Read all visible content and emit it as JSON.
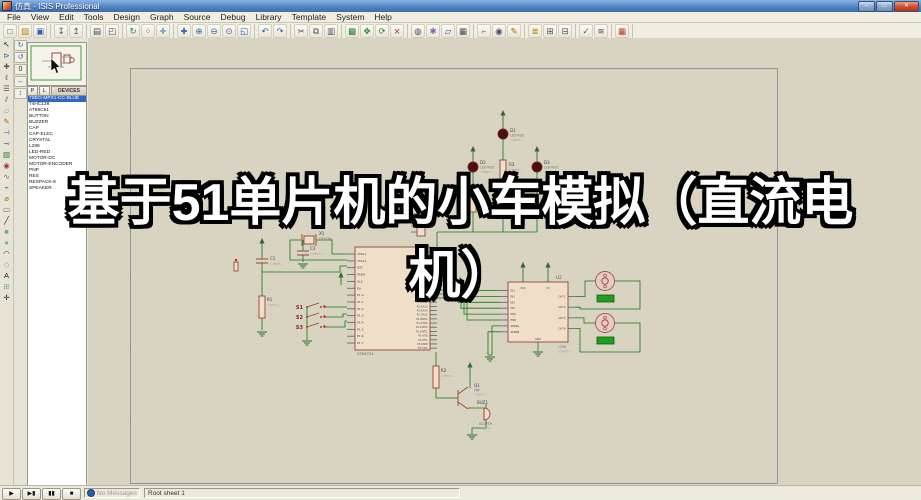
{
  "window": {
    "title": "仿真 - ISIS Professional",
    "controls": {
      "minimize": "–",
      "maximize": "□",
      "close": "✕"
    }
  },
  "menu": {
    "items": [
      "File",
      "View",
      "Edit",
      "Tools",
      "Design",
      "Graph",
      "Source",
      "Debug",
      "Library",
      "Template",
      "System",
      "Help"
    ]
  },
  "toolbar": {
    "groups": [
      [
        {
          "n": "new-file-icon",
          "g": "□"
        },
        {
          "n": "open-design-icon",
          "g": "▨",
          "c": "#b8860b"
        },
        {
          "n": "save-design-icon",
          "g": "▣",
          "c": "#2f5fa8"
        }
      ],
      [
        {
          "n": "import-section-icon",
          "g": "↧"
        },
        {
          "n": "export-section-icon",
          "g": "↥"
        }
      ],
      [
        {
          "n": "print-icon",
          "g": "▤"
        },
        {
          "n": "mark-output-area-icon",
          "g": "◰"
        }
      ],
      [
        {
          "n": "redraw-icon",
          "g": "↻",
          "c": "#2e7d32"
        },
        {
          "n": "toggle-grid-icon",
          "g": "⁘"
        },
        {
          "n": "false-origin-icon",
          "g": "✛",
          "c": "#2f5fa8"
        }
      ],
      [
        {
          "n": "center-at-cursor-icon",
          "g": "✚",
          "c": "#2f5fa8"
        },
        {
          "n": "zoom-in-icon",
          "g": "⊕",
          "c": "#2f5fa8"
        },
        {
          "n": "zoom-out-icon",
          "g": "⊖",
          "c": "#2f5fa8"
        },
        {
          "n": "zoom-all-icon",
          "g": "⊙",
          "c": "#2f5fa8"
        },
        {
          "n": "zoom-area-icon",
          "g": "◱",
          "c": "#2f5fa8"
        }
      ],
      [
        {
          "n": "undo-icon",
          "g": "↶",
          "c": "#2f5fa8"
        },
        {
          "n": "redo-icon",
          "g": "↷",
          "c": "#2f5fa8"
        }
      ],
      [
        {
          "n": "cut-icon",
          "g": "✂"
        },
        {
          "n": "copy-icon",
          "g": "⧉"
        },
        {
          "n": "paste-icon",
          "g": "▥"
        }
      ],
      [
        {
          "n": "block-copy-icon",
          "g": "▩",
          "c": "#2e7d32"
        },
        {
          "n": "block-move-icon",
          "g": "✥",
          "c": "#2e7d32"
        },
        {
          "n": "block-rotate-icon",
          "g": "⟳",
          "c": "#2e7d32"
        },
        {
          "n": "block-delete-icon",
          "g": "⨯",
          "c": "#a33333"
        }
      ],
      [
        {
          "n": "pick-parts-icon",
          "g": "◍"
        },
        {
          "n": "make-device-icon",
          "g": "✱",
          "c": "#8a5fb0"
        },
        {
          "n": "packaging-tool-icon",
          "g": "▱"
        },
        {
          "n": "decompose-icon",
          "g": "▦"
        }
      ],
      [
        {
          "n": "wire-autorouter-icon",
          "g": "⌐",
          "c": "#2e7d32"
        },
        {
          "n": "search-tag-icon",
          "g": "◉"
        },
        {
          "n": "property-assignment-icon",
          "g": "✎",
          "c": "#a66a00"
        }
      ],
      [
        {
          "n": "design-explorer-icon",
          "g": "≣",
          "c": "#b8860b"
        },
        {
          "n": "new-sheet-icon",
          "g": "⊞"
        },
        {
          "n": "remove-sheet-icon",
          "g": "⊟"
        }
      ],
      [
        {
          "n": "electrical-rules-check-icon",
          "g": "✓",
          "c": "#2e7d32"
        },
        {
          "n": "netlist-compiler-icon",
          "g": "≋"
        }
      ],
      [
        {
          "n": "netlist-to-ares-icon",
          "g": "▦",
          "c": "#c0392b"
        }
      ]
    ]
  },
  "tools_left": [
    {
      "n": "selection-mode-icon",
      "g": "↖",
      "c": "#222222"
    },
    {
      "n": "component-mode-icon",
      "g": "⊳",
      "c": "#2f5fa8"
    },
    {
      "n": "junction-dot-icon",
      "g": "✚",
      "c": "#556"
    },
    {
      "n": "wire-label-icon",
      "g": "ℓ",
      "c": "#556"
    },
    {
      "n": "text-script-icon",
      "g": "☰",
      "c": "#556"
    },
    {
      "n": "buses-mode-icon",
      "g": "⫽",
      "c": "#2f5fa8"
    },
    {
      "n": "subcircuit-icon",
      "g": "▱",
      "c": "#7a9"
    },
    {
      "n": "instant-edit-icon",
      "g": "✎",
      "c": "#a66a00"
    },
    {
      "n": "terminals-icon",
      "g": "⊣",
      "c": "#2f5fa8"
    },
    {
      "n": "device-pins-icon",
      "g": "⊸",
      "c": "#556"
    },
    {
      "n": "graph-mode-icon",
      "g": "▧",
      "c": "#2e7d32"
    },
    {
      "n": "tape-recorder-icon",
      "g": "◉",
      "c": "#a33333"
    },
    {
      "n": "generator-icon",
      "g": "∿",
      "c": "#2e7d32"
    },
    {
      "n": "voltage-probe-icon",
      "g": "⌁",
      "c": "#2f5fa8"
    },
    {
      "n": "current-probe-icon",
      "g": "⌀",
      "c": "#a66a00"
    },
    {
      "n": "instruments-icon",
      "g": "▭",
      "c": "#556"
    },
    {
      "n": "line-2d-icon",
      "g": "╱",
      "c": "#222222"
    },
    {
      "n": "box-2d-icon",
      "g": "■",
      "c": "#7a9"
    },
    {
      "n": "circle-2d-icon",
      "g": "●",
      "c": "#7a9"
    },
    {
      "n": "arc-2d-icon",
      "g": "◠",
      "c": "#222222"
    },
    {
      "n": "path-2d-icon",
      "g": "◇",
      "c": "#7a9"
    },
    {
      "n": "text-2d-icon",
      "g": "A",
      "c": "#222222"
    },
    {
      "n": "symbol-2d-icon",
      "g": "⊞",
      "c": "#7a9"
    },
    {
      "n": "marker-origin-icon",
      "g": "✛",
      "c": "#222222"
    }
  ],
  "orientation": [
    {
      "n": "rotate-cw-icon",
      "g": "↻",
      "c": "#2f5fa8"
    },
    {
      "n": "rotate-ccw-icon",
      "g": "↺",
      "c": "#2f5fa8"
    },
    {
      "n": "rotate-angle-field",
      "g": "0",
      "c": "#333333"
    },
    {
      "n": "mirror-h-icon",
      "g": "↔",
      "c": "#2f5fa8"
    },
    {
      "n": "mirror-v-icon",
      "g": "↕",
      "c": "#2f5fa8"
    }
  ],
  "sidebar": {
    "pl_buttons": [
      "P",
      "L"
    ],
    "devices_header": "DEVICES",
    "selected_device": "7SEG-MPX1-CC-BLUE",
    "devices": [
      "7SEG-MPX1-CC-BLUE",
      "74HC138",
      "AT89C51",
      "BUTTON",
      "BUZZER",
      "CAP",
      "CAP-ELEC",
      "CRYSTAL",
      "L298",
      "LED-RED",
      "MOTOR-DC",
      "MOTOR-ENCODER",
      "PNP",
      "RES",
      "RESPACK-8",
      "SPEAKER"
    ]
  },
  "overlay": {
    "title": "基于51单片机的小车模拟（直流电机）",
    "line1": "基于51单片机的小车模拟（直流电",
    "line2": "机）"
  },
  "schematic": {
    "mcu": {
      "name": "AT89C51",
      "left_pins": [
        "XTAL1",
        "XTAL2",
        "RST",
        "PSEN",
        "ALE",
        "EA",
        "P1.0",
        "P1.1",
        "P1.2",
        "P1.3",
        "P1.4",
        "P1.5",
        "P1.6",
        "P1.7"
      ],
      "right_pins": [
        "P0.0/AD0",
        "P0.1/AD1",
        "P0.2/AD2",
        "P0.3/AD3",
        "P0.4/AD4",
        "P0.5/AD5",
        "P0.6/AD6",
        "P0.7/AD7",
        "P2.0/A8",
        "P2.1/A9",
        "P2.2/A10",
        "P2.3/A11",
        "P2.4/A12",
        "P2.5/A13",
        "P2.6/A14",
        "P2.7/A15",
        "P3.0/RXD",
        "P3.1/TXD",
        "P3.2/INT0",
        "P3.3/INT1",
        "P3.4/T0",
        "P3.5/T1",
        "P3.6/WR",
        "P3.7/RD"
      ]
    },
    "driver": {
      "ref": "U2",
      "name": "L298",
      "note": "<TEXT>",
      "left_pins": [
        "IN1",
        "IN2",
        "IN3",
        "IN4",
        "ENA",
        "ENB",
        "SENSA",
        "SENSB"
      ],
      "right_pins": [
        "OUT1",
        "OUT2",
        "OUT3",
        "OUT4"
      ],
      "top_pins": [
        "VCC",
        "VS"
      ],
      "bottom_pin": "GND"
    },
    "leds": [
      {
        "ref": "D1",
        "value": "LED-RED",
        "note": "<TEXT>"
      },
      {
        "ref": "D2",
        "value": "LED-RED",
        "note": "<TEXT>"
      },
      {
        "ref": "D3",
        "value": "LED-RED",
        "note": "<TEXT>"
      }
    ],
    "resistors": [
      {
        "ref": "R1",
        "note": "<TEXT>"
      },
      {
        "ref": "R2",
        "note": "<TEXT>"
      },
      {
        "ref": "R3",
        "note": "<TEXT>"
      },
      {
        "ref": "R4",
        "note": "<TEXT>"
      }
    ],
    "caps": [
      {
        "ref": "C1",
        "note": "<TEXT>"
      },
      {
        "ref": "C3",
        "note": "<TEXT>"
      }
    ],
    "crystal": {
      "ref": "X1",
      "value": "CRYSTAL"
    },
    "buttons": [
      {
        "ref": "S1"
      },
      {
        "ref": "S2"
      },
      {
        "ref": "S3"
      }
    ],
    "transistor": {
      "ref": "Q1",
      "value": "PNP",
      "note": "<TEXT>"
    },
    "buzzer": {
      "ref": "BUZ1",
      "value": "BUZZER",
      "note": "<TEXT>"
    }
  },
  "statusbar": {
    "sim": [
      {
        "n": "play-button",
        "g": "▶"
      },
      {
        "n": "step-button",
        "g": "▶▮"
      },
      {
        "n": "pause-button",
        "g": "▮▮"
      },
      {
        "n": "stop-button",
        "g": "■"
      }
    ],
    "message": "No Messages",
    "sheet_label": "Root sheet 1"
  },
  "colors": {
    "selection": "#3166c4",
    "wire": "#167616",
    "component_outline": "#96443c",
    "canvas": "#d8d4c1",
    "caption_fill": "#ffffff",
    "caption_outline": "#000000"
  }
}
